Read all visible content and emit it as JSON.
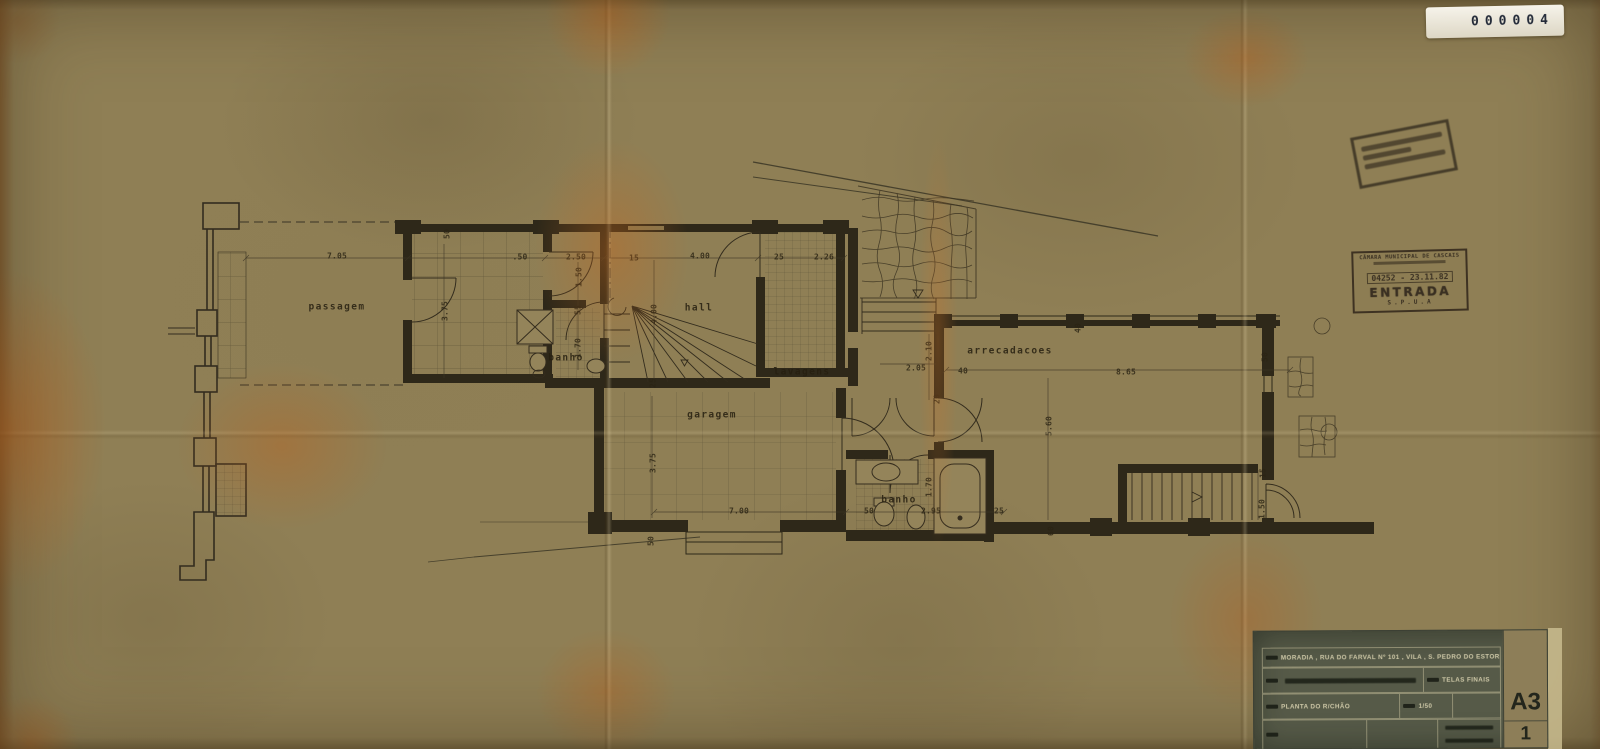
{
  "sticker": {
    "number": "000004"
  },
  "stamps": {
    "entrada": {
      "line1": "CÂMARA MUNICIPAL DE CASCAIS",
      "number": "04252 - 23.11.82",
      "big": "ENTRADA",
      "dept": "S.P.U.A"
    }
  },
  "title_block": {
    "project": "MORADIA , RUA DO FARVAL Nº 101 , VILA , S. PEDRO DO ESTORIL",
    "note": "TELAS FINAIS",
    "drawing": "PLANTA DO R/CHÃO",
    "scale": "1/50",
    "sheet_size": "A3",
    "sheet_number": "1"
  },
  "plan": {
    "rooms": [
      {
        "label": "passagem",
        "x": 337,
        "y": 307
      },
      {
        "label": "banho",
        "x": 566,
        "y": 358
      },
      {
        "label": "hall",
        "x": 699,
        "y": 308
      },
      {
        "label": "lavagens",
        "x": 802,
        "y": 372
      },
      {
        "label": "garagem",
        "x": 712,
        "y": 415
      },
      {
        "label": "arrecadacoes",
        "x": 1010,
        "y": 351
      },
      {
        "label": "banho",
        "x": 899,
        "y": 500
      }
    ],
    "dims": [
      {
        "t": "7.05",
        "x": 337,
        "y": 256,
        "r": 0
      },
      {
        "t": ".50",
        "x": 520,
        "y": 257,
        "r": 0
      },
      {
        "t": "2.50",
        "x": 576,
        "y": 257,
        "r": 0
      },
      {
        "t": "15",
        "x": 634,
        "y": 258,
        "r": 0
      },
      {
        "t": "4.00",
        "x": 700,
        "y": 256,
        "r": 0
      },
      {
        "t": "25",
        "x": 779,
        "y": 257,
        "r": 0
      },
      {
        "t": "2.26",
        "x": 824,
        "y": 257,
        "r": 0
      },
      {
        "t": "50",
        "x": 447,
        "y": 234,
        "r": -90
      },
      {
        "t": "1.50",
        "x": 579,
        "y": 277,
        "r": -90
      },
      {
        "t": "3.75",
        "x": 445,
        "y": 311,
        "r": -90
      },
      {
        "t": "55",
        "x": 578,
        "y": 310,
        "r": -90
      },
      {
        "t": "1.70",
        "x": 578,
        "y": 348,
        "r": -90
      },
      {
        "t": "4.00",
        "x": 654,
        "y": 314,
        "r": -90
      },
      {
        "t": "25",
        "x": 653,
        "y": 383,
        "r": -90
      },
      {
        "t": "3.75",
        "x": 653,
        "y": 463,
        "r": -90
      },
      {
        "t": "50",
        "x": 651,
        "y": 541,
        "r": -90
      },
      {
        "t": "7.00",
        "x": 739,
        "y": 511,
        "r": 0
      },
      {
        "t": "50",
        "x": 869,
        "y": 511,
        "r": 0
      },
      {
        "t": "2.95",
        "x": 931,
        "y": 511,
        "r": 0
      },
      {
        "t": "25",
        "x": 999,
        "y": 511,
        "r": 0
      },
      {
        "t": "1.70",
        "x": 929,
        "y": 487,
        "r": -90
      },
      {
        "t": "2.05",
        "x": 916,
        "y": 368,
        "r": 0
      },
      {
        "t": "2.10",
        "x": 929,
        "y": 351,
        "r": -90
      },
      {
        "t": "20",
        "x": 937,
        "y": 399,
        "r": -90
      },
      {
        "t": "40",
        "x": 963,
        "y": 371,
        "r": 0
      },
      {
        "t": "8.65",
        "x": 1126,
        "y": 372,
        "r": 0
      },
      {
        "t": "40",
        "x": 1078,
        "y": 328,
        "r": -90
      },
      {
        "t": "5.60",
        "x": 1049,
        "y": 426,
        "r": -90
      },
      {
        "t": "60",
        "x": 1051,
        "y": 531,
        "r": -90
      },
      {
        "t": "50",
        "x": 1265,
        "y": 357,
        "r": -90
      },
      {
        "t": "15",
        "x": 1263,
        "y": 473,
        "r": -90
      },
      {
        "t": "1.50",
        "x": 1262,
        "y": 509,
        "r": -90
      }
    ]
  }
}
